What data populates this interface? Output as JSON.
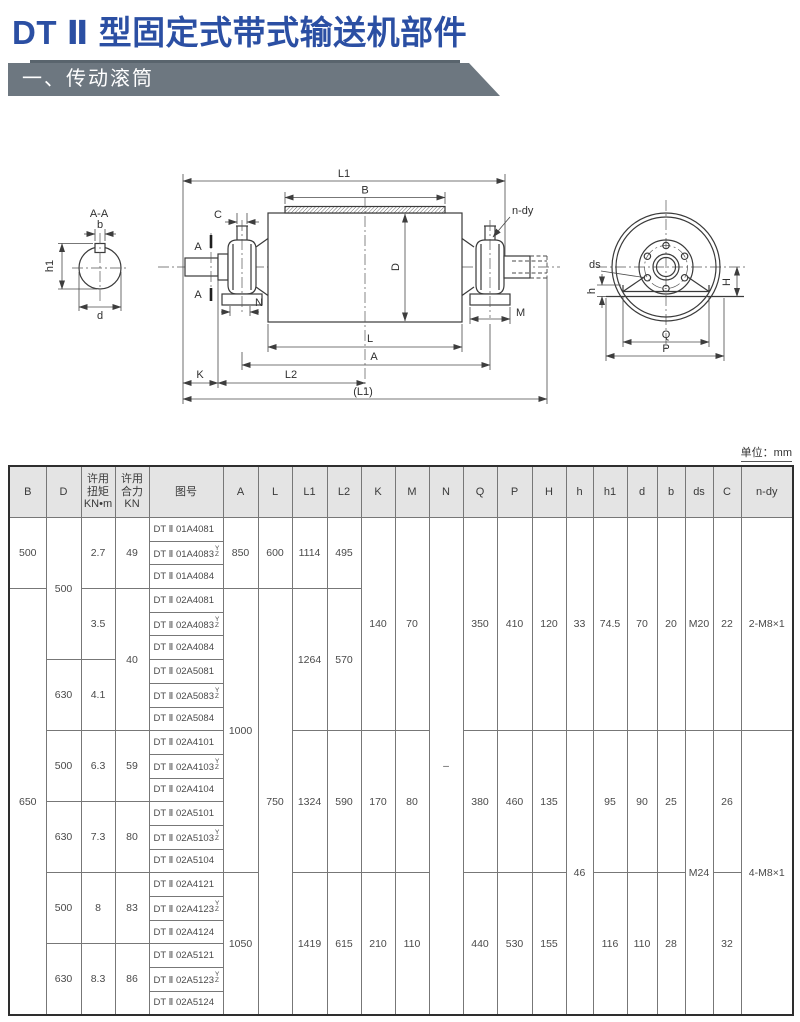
{
  "page": {
    "title": "DT Ⅱ 型固定式带式输送机部件"
  },
  "section": {
    "label": "一、传动滚筒"
  },
  "colors": {
    "title": "#2b4fa3",
    "section_bar": "#6d7780",
    "section_bar_accent": "#59646d",
    "table_header_bg": "#e4e4e4",
    "text": "#4a4a4a"
  },
  "drawing": {
    "labels": {
      "section_title": "A-A",
      "b": "b",
      "h1": "h1",
      "d": "d",
      "L1_top": "L1",
      "B": "B",
      "C": "C",
      "D": "D",
      "N": "N",
      "M": "M",
      "L": "L",
      "A": "A",
      "K": "K",
      "L2": "L2",
      "L1_bottom": "(L1)",
      "n_dy": "n-dy",
      "section_mark": "A",
      "ds": "ds",
      "h": "h",
      "H": "H",
      "Q": "Q",
      "P": "P"
    }
  },
  "table": {
    "unit_note": "单位：mm",
    "row_count": 21,
    "headers": [
      {
        "id": "B",
        "lines": [
          "B"
        ],
        "width": 37
      },
      {
        "id": "D",
        "lines": [
          "D"
        ],
        "width": 35
      },
      {
        "id": "torque",
        "lines": [
          "许用",
          "扭矩",
          "KN•m"
        ],
        "width": 34
      },
      {
        "id": "force",
        "lines": [
          "许用",
          "合力",
          "KN"
        ],
        "width": 34
      },
      {
        "id": "fig",
        "lines": [
          "图号"
        ],
        "width": 74
      },
      {
        "id": "A",
        "lines": [
          "A"
        ],
        "width": 35
      },
      {
        "id": "L",
        "lines": [
          "L"
        ],
        "width": 34
      },
      {
        "id": "L1",
        "lines": [
          "L1"
        ],
        "width": 35
      },
      {
        "id": "L2",
        "lines": [
          "L2"
        ],
        "width": 34
      },
      {
        "id": "K",
        "lines": [
          "K"
        ],
        "width": 34
      },
      {
        "id": "M",
        "lines": [
          "M"
        ],
        "width": 34
      },
      {
        "id": "N",
        "lines": [
          "N"
        ],
        "width": 34
      },
      {
        "id": "Q",
        "lines": [
          "Q"
        ],
        "width": 34
      },
      {
        "id": "P",
        "lines": [
          "P"
        ],
        "width": 35
      },
      {
        "id": "H",
        "lines": [
          "H"
        ],
        "width": 34
      },
      {
        "id": "h",
        "lines": [
          "h"
        ],
        "width": 27
      },
      {
        "id": "h1",
        "lines": [
          "h1"
        ],
        "width": 34
      },
      {
        "id": "d",
        "lines": [
          "d"
        ],
        "width": 30
      },
      {
        "id": "b",
        "lines": [
          "b"
        ],
        "width": 28
      },
      {
        "id": "ds",
        "lines": [
          "ds"
        ],
        "width": 28
      },
      {
        "id": "C",
        "lines": [
          "C"
        ],
        "width": 28
      },
      {
        "id": "n_dy",
        "lines": [
          "n-dy"
        ],
        "width": 52
      }
    ],
    "drawing_numbers": [
      {
        "text": "DT Ⅱ 01A4081"
      },
      {
        "text": "DT Ⅱ 01A4083",
        "sup": "Y",
        "sub": "Z"
      },
      {
        "text": "DT Ⅱ 01A4084"
      },
      {
        "text": "DT Ⅱ 02A4081"
      },
      {
        "text": "DT Ⅱ 02A4083",
        "sup": "Y",
        "sub": "Z"
      },
      {
        "text": "DT Ⅱ 02A4084"
      },
      {
        "text": "DT Ⅱ 02A5081"
      },
      {
        "text": "DT Ⅱ 02A5083",
        "sup": "Y",
        "sub": "Z"
      },
      {
        "text": "DT Ⅱ 02A5084"
      },
      {
        "text": "DT Ⅱ 02A4101"
      },
      {
        "text": "DT Ⅱ 02A4103",
        "sup": "Y",
        "sub": "Z"
      },
      {
        "text": "DT Ⅱ 02A4104"
      },
      {
        "text": "DT Ⅱ 02A5101"
      },
      {
        "text": "DT Ⅱ 02A5103",
        "sup": "Y",
        "sub": "Z"
      },
      {
        "text": "DT Ⅱ 02A5104"
      },
      {
        "text": "DT Ⅱ 02A4121"
      },
      {
        "text": "DT Ⅱ 02A4123",
        "sup": "Y",
        "sub": "Z"
      },
      {
        "text": "DT Ⅱ 02A4124"
      },
      {
        "text": "DT Ⅱ 02A5121"
      },
      {
        "text": "DT Ⅱ 02A5123",
        "sup": "Y",
        "sub": "Z"
      },
      {
        "text": "DT Ⅱ 02A5124"
      }
    ],
    "spans": {
      "B": [
        {
          "rows": 3,
          "v": "500"
        },
        {
          "rows": 18,
          "v": "650"
        }
      ],
      "D": [
        {
          "rows": 6,
          "v": "500"
        },
        {
          "rows": 3,
          "v": "630"
        },
        {
          "rows": 3,
          "v": "500"
        },
        {
          "rows": 3,
          "v": "630"
        },
        {
          "rows": 3,
          "v": "500"
        },
        {
          "rows": 3,
          "v": "630"
        }
      ],
      "torque": [
        {
          "rows": 3,
          "v": "2.7"
        },
        {
          "rows": 3,
          "v": "3.5"
        },
        {
          "rows": 3,
          "v": "4.1"
        },
        {
          "rows": 3,
          "v": "6.3"
        },
        {
          "rows": 3,
          "v": "7.3"
        },
        {
          "rows": 3,
          "v": "8"
        },
        {
          "rows": 3,
          "v": "8.3"
        }
      ],
      "force": [
        {
          "rows": 3,
          "v": "49"
        },
        {
          "rows": 6,
          "v": "40"
        },
        {
          "rows": 3,
          "v": "59"
        },
        {
          "rows": 3,
          "v": "80"
        },
        {
          "rows": 3,
          "v": "83"
        },
        {
          "rows": 3,
          "v": "86"
        }
      ],
      "A": [
        {
          "rows": 3,
          "v": "850"
        },
        {
          "rows": 12,
          "v": "1000"
        },
        {
          "rows": 6,
          "v": "1050"
        }
      ],
      "L": [
        {
          "rows": 3,
          "v": "600"
        },
        {
          "rows": 18,
          "v": "750"
        }
      ],
      "L1": [
        {
          "rows": 3,
          "v": "1114"
        },
        {
          "rows": 6,
          "v": "1264"
        },
        {
          "rows": 6,
          "v": "1324"
        },
        {
          "rows": 6,
          "v": "1419"
        }
      ],
      "L2": [
        {
          "rows": 3,
          "v": "495"
        },
        {
          "rows": 6,
          "v": "570"
        },
        {
          "rows": 6,
          "v": "590"
        },
        {
          "rows": 6,
          "v": "615"
        }
      ],
      "K": [
        {
          "rows": 9,
          "v": "140"
        },
        {
          "rows": 6,
          "v": "170"
        },
        {
          "rows": 6,
          "v": "210"
        }
      ],
      "M": [
        {
          "rows": 9,
          "v": "70"
        },
        {
          "rows": 6,
          "v": "80"
        },
        {
          "rows": 6,
          "v": "110"
        }
      ],
      "N": [
        {
          "rows": 21,
          "v": "–"
        }
      ],
      "Q": [
        {
          "rows": 9,
          "v": "350"
        },
        {
          "rows": 6,
          "v": "380"
        },
        {
          "rows": 6,
          "v": "440"
        }
      ],
      "P": [
        {
          "rows": 9,
          "v": "410"
        },
        {
          "rows": 6,
          "v": "460"
        },
        {
          "rows": 6,
          "v": "530"
        }
      ],
      "H": [
        {
          "rows": 9,
          "v": "120"
        },
        {
          "rows": 6,
          "v": "135"
        },
        {
          "rows": 6,
          "v": "155"
        }
      ],
      "h": [
        {
          "rows": 9,
          "v": "33"
        },
        {
          "rows": 12,
          "v": "46"
        }
      ],
      "h1": [
        {
          "rows": 9,
          "v": "74.5"
        },
        {
          "rows": 6,
          "v": "95"
        },
        {
          "rows": 6,
          "v": "116"
        }
      ],
      "d": [
        {
          "rows": 9,
          "v": "70"
        },
        {
          "rows": 6,
          "v": "90"
        },
        {
          "rows": 6,
          "v": "110"
        }
      ],
      "b": [
        {
          "rows": 9,
          "v": "20"
        },
        {
          "rows": 6,
          "v": "25"
        },
        {
          "rows": 6,
          "v": "28"
        }
      ],
      "ds": [
        {
          "rows": 9,
          "v": "M20"
        },
        {
          "rows": 12,
          "v": "M24"
        }
      ],
      "C": [
        {
          "rows": 9,
          "v": "22"
        },
        {
          "rows": 6,
          "v": "26"
        },
        {
          "rows": 6,
          "v": "32"
        }
      ],
      "n_dy": [
        {
          "rows": 9,
          "v": "2-M8×1"
        },
        {
          "rows": 12,
          "v": "4-M8×1"
        }
      ]
    }
  }
}
